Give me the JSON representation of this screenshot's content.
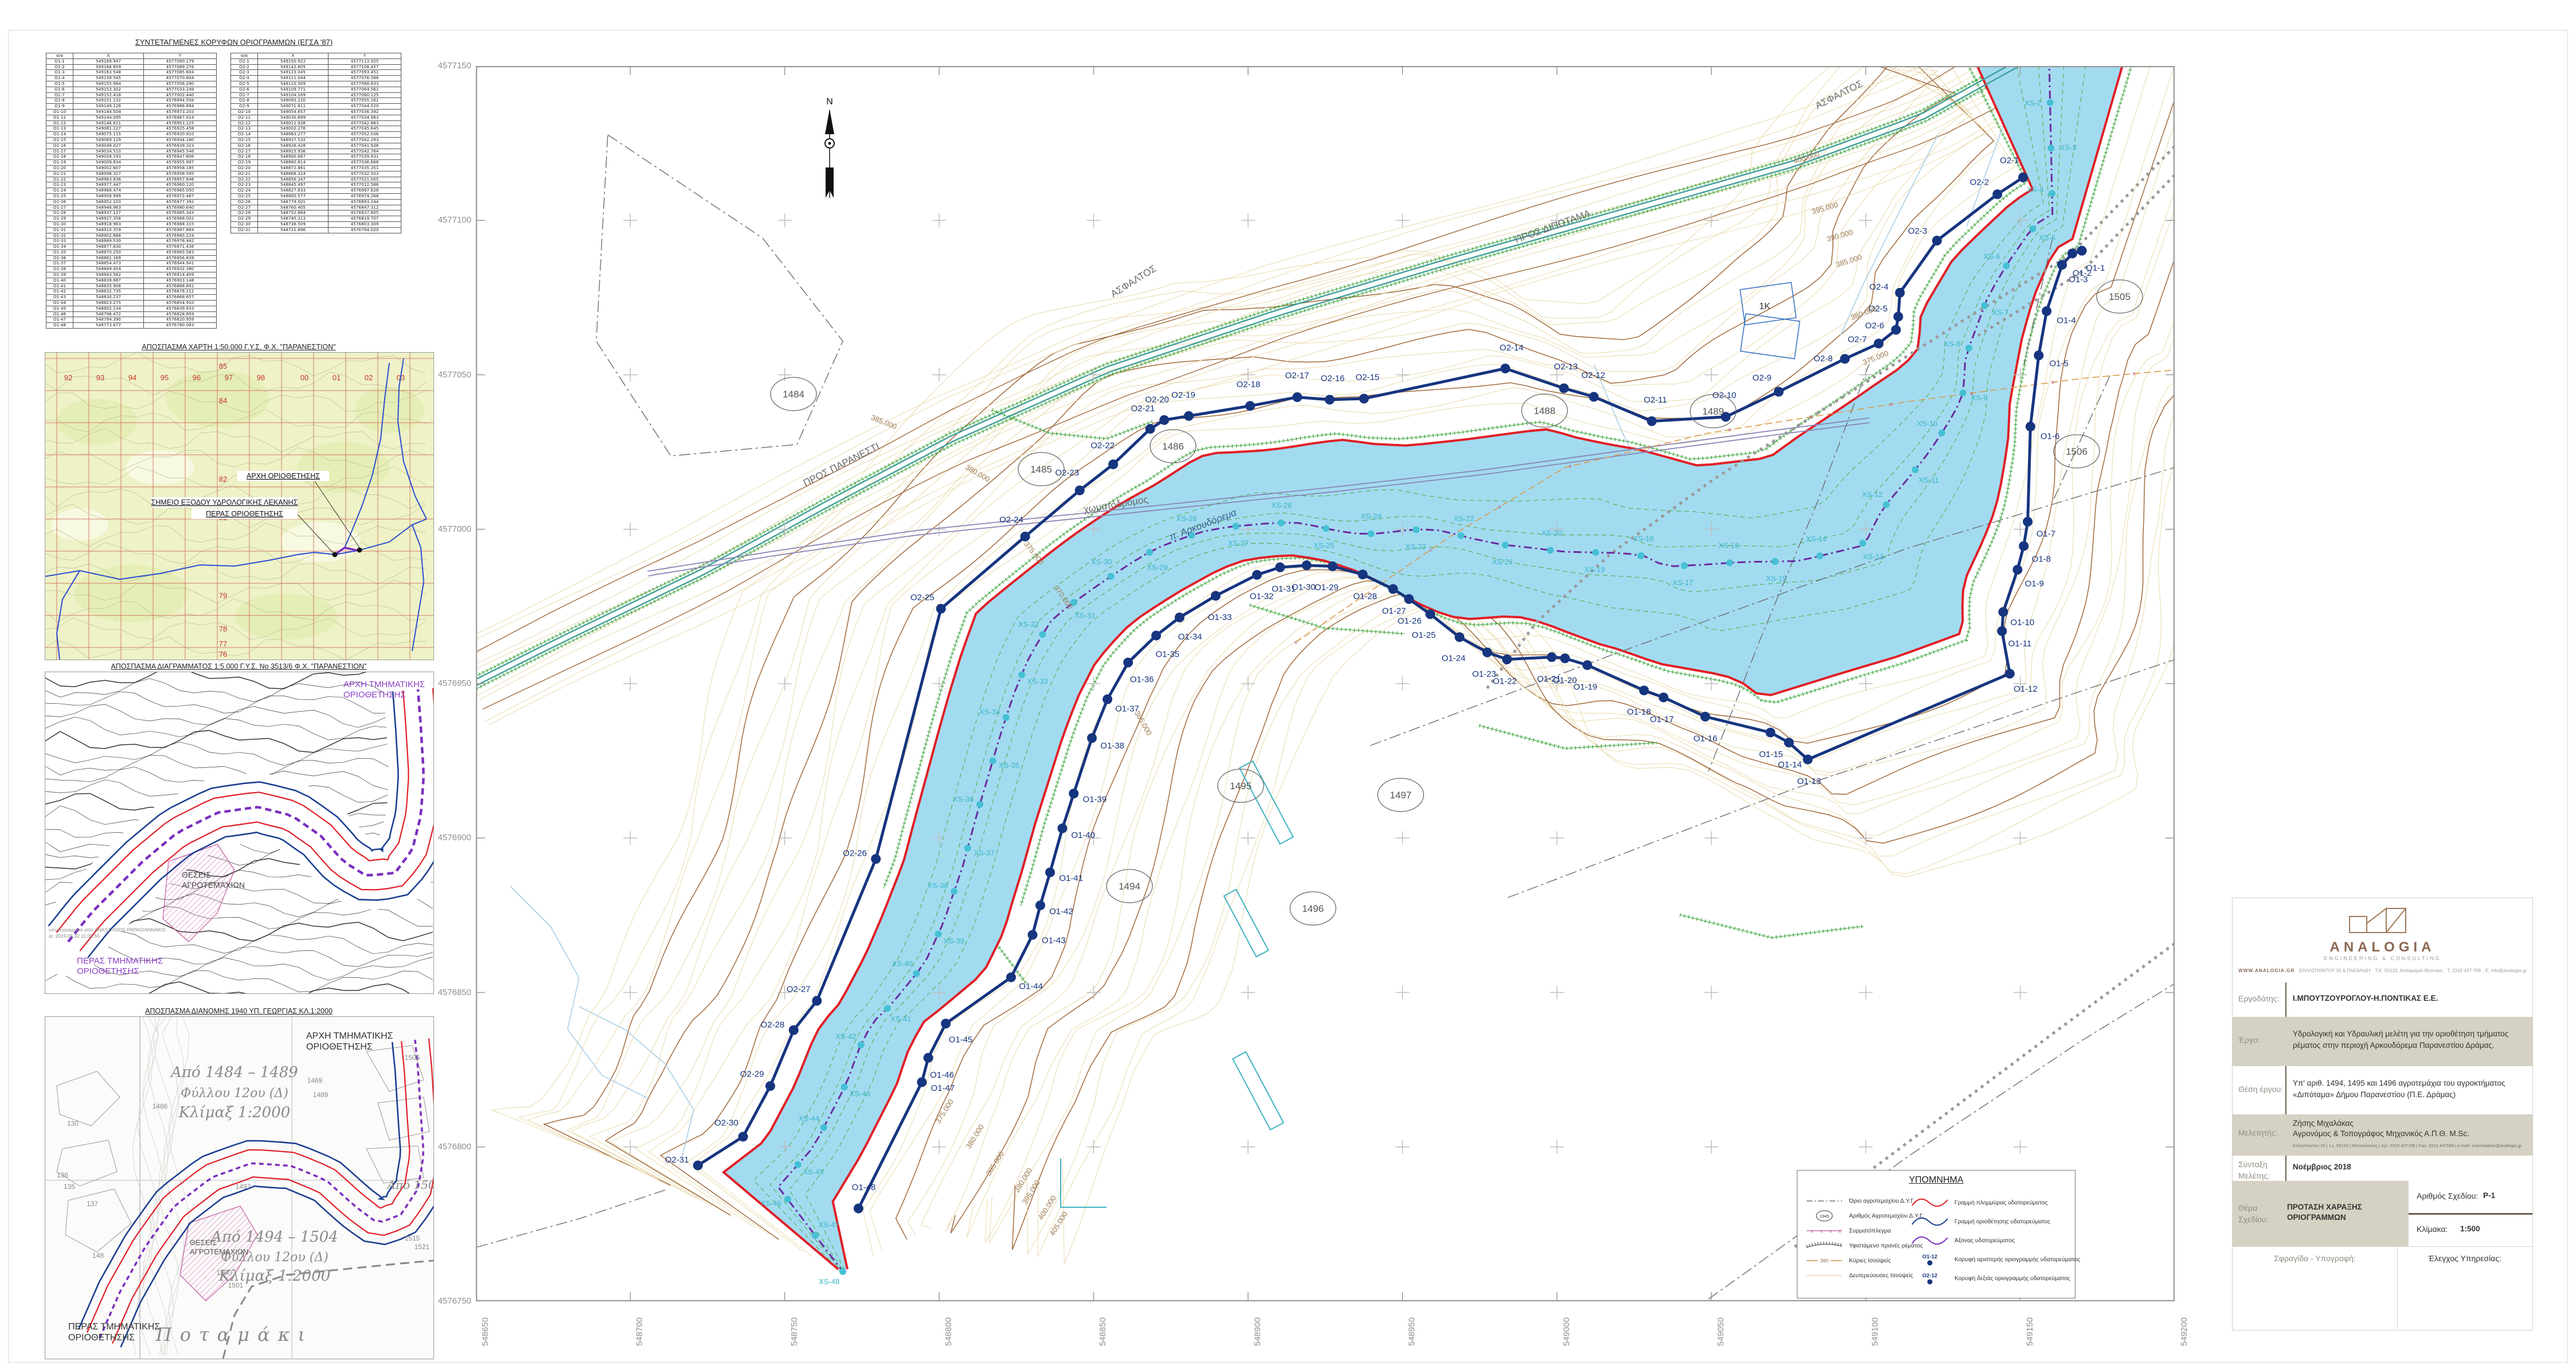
{
  "tables": {
    "title": "ΣΥΝΤΕΤΑΓΜΕΝΕΣ ΚΟΡΥΦΩΝ ΟΡΙΟΓΡΑΜΜΩΝ (ΕΓΣΑ '87)",
    "columns": [
      "α/α",
      "X",
      "Y"
    ],
    "o1": [
      [
        "O1-1",
        "549169.947",
        "4577090.179"
      ],
      [
        "O1-2",
        "549166.859",
        "4577089.276"
      ],
      [
        "O1-3",
        "549163.548",
        "4577085.604"
      ],
      [
        "O1-4",
        "549158.545",
        "4577070.604"
      ],
      [
        "O1-5",
        "549155.984",
        "4577056.290"
      ],
      [
        "O1-6",
        "549153.302",
        "4577033.249"
      ],
      [
        "O1-7",
        "549152.418",
        "4577002.440"
      ],
      [
        "O1-8",
        "549151.132",
        "4576994.556"
      ],
      [
        "O1-9",
        "549149.128",
        "4576986.894"
      ],
      [
        "O1-10",
        "549144.504",
        "4576973.203"
      ],
      [
        "O1-11",
        "549144.095",
        "4576967.014"
      ],
      [
        "O1-12",
        "549146.611",
        "4576953.225"
      ],
      [
        "O1-13",
        "549081.227",
        "4576925.458"
      ],
      [
        "O1-14",
        "549075.115",
        "4576930.910"
      ],
      [
        "O1-15",
        "549069.129",
        "4576934.180"
      ],
      [
        "O1-16",
        "549048.027",
        "4576939.323"
      ],
      [
        "O1-17",
        "549034.510",
        "4576945.546"
      ],
      [
        "O1-18",
        "549028.193",
        "4576947.806"
      ],
      [
        "O1-19",
        "549009.834",
        "4576955.997"
      ],
      [
        "O1-20",
        "549002.607",
        "4576958.185"
      ],
      [
        "O1-21",
        "548998.327",
        "4576958.595"
      ],
      [
        "O1-22",
        "548983.836",
        "4576957.846"
      ],
      [
        "O1-23",
        "548977.447",
        "4576960.120"
      ],
      [
        "O1-24",
        "548968.474",
        "4576965.050"
      ],
      [
        "O1-25",
        "548958.999",
        "4576972.487"
      ],
      [
        "O1-26",
        "548952.103",
        "4576977.392"
      ],
      [
        "O1-27",
        "548946.963",
        "4576980.640"
      ],
      [
        "O1-28",
        "548937.127",
        "4576985.343"
      ],
      [
        "O1-29",
        "548927.358",
        "4576988.002"
      ],
      [
        "O1-30",
        "548918.963",
        "4576988.315"
      ],
      [
        "O1-31",
        "548910.359",
        "4576987.664"
      ],
      [
        "O1-32",
        "548902.888",
        "4576985.224"
      ],
      [
        "O1-33",
        "548889.530",
        "4576978.442"
      ],
      [
        "O1-34",
        "548877.830",
        "4576971.436"
      ],
      [
        "O1-35",
        "548870.250",
        "4576965.583"
      ],
      [
        "O1-36",
        "548861.169",
        "4576956.839"
      ],
      [
        "O1-37",
        "548854.473",
        "4576944.941"
      ],
      [
        "O1-38",
        "548849.454",
        "4576932.380"
      ],
      [
        "O1-39",
        "548843.562",
        "4576914.409"
      ],
      [
        "O1-40",
        "548839.887",
        "4576903.148"
      ],
      [
        "O1-41",
        "548835.906",
        "4576888.891"
      ],
      [
        "O1-42",
        "548832.735",
        "4576878.212"
      ],
      [
        "O1-43",
        "548830.237",
        "4576868.657"
      ],
      [
        "O1-44",
        "548823.275",
        "4576854.910"
      ],
      [
        "O1-45",
        "548802.134",
        "4576839.933"
      ],
      [
        "O1-46",
        "548796.472",
        "4576828.859"
      ],
      [
        "O1-47",
        "548794.390",
        "4576820.959"
      ],
      [
        "O1-48",
        "548773.877",
        "4576780.083"
      ]
    ],
    "o2": [
      [
        "O2-1",
        "549150.922",
        "4577113.925"
      ],
      [
        "O2-2",
        "549142.605",
        "4577108.457"
      ],
      [
        "O2-3",
        "549123.045",
        "4577093.451"
      ],
      [
        "O2-4",
        "549111.044",
        "4577076.586"
      ],
      [
        "O2-5",
        "549110.509",
        "4577068.833"
      ],
      [
        "O2-6",
        "549109.771",
        "4577064.561"
      ],
      [
        "O2-7",
        "549104.169",
        "4577060.125"
      ],
      [
        "O2-8",
        "549093.220",
        "4577055.161"
      ],
      [
        "O2-9",
        "549071.811",
        "4577044.520"
      ],
      [
        "O2-10",
        "549054.657",
        "4577036.392"
      ],
      [
        "O2-11",
        "549030.699",
        "4577034.983"
      ],
      [
        "O2-12",
        "549011.938",
        "4577042.883"
      ],
      [
        "O2-13",
        "549002.276",
        "4577045.645"
      ],
      [
        "O2-14",
        "548983.277",
        "4577052.036"
      ],
      [
        "O2-15",
        "548937.532",
        "4577042.293"
      ],
      [
        "O2-16",
        "548926.428",
        "4577041.936"
      ],
      [
        "O2-17",
        "548915.936",
        "4577042.764"
      ],
      [
        "O2-18",
        "548900.667",
        "4577039.931"
      ],
      [
        "O2-19",
        "548880.814",
        "4577036.668"
      ],
      [
        "O2-20",
        "548872.861",
        "4577035.351"
      ],
      [
        "O2-21",
        "548868.324",
        "4577032.503"
      ],
      [
        "O2-22",
        "548856.347",
        "4577021.005"
      ],
      [
        "O2-23",
        "548845.497",
        "4577012.588"
      ],
      [
        "O2-24",
        "548827.833",
        "4576997.628"
      ],
      [
        "O2-25",
        "548800.577",
        "4576974.268"
      ],
      [
        "O2-26",
        "548779.501",
        "4576893.244"
      ],
      [
        "O2-27",
        "548760.405",
        "4576847.312"
      ],
      [
        "O2-28",
        "548752.884",
        "4576837.805"
      ],
      [
        "O2-29",
        "548745.313",
        "4576819.707"
      ],
      [
        "O2-30",
        "548736.509",
        "4576803.309"
      ],
      [
        "O2-31",
        "548721.896",
        "4576794.020"
      ]
    ]
  },
  "insets": {
    "map50k": {
      "title": "ΑΠΟΣΠΑΣΜΑ ΧΑΡΤΗ 1:50.000 Γ.Υ.Σ. Φ.Χ. \"ΠΑΡΑΝΕΣΤΙΟΝ\"",
      "labels": {
        "arxi": "ΑΡΧΗ ΟΡΙΟΘΕΤΗΣΗΣ",
        "shmeio": "ΣΗΜΕΙΟ ΕΞΟΔΟΥ ΥΔΡΟΛΟΓΙΚΗΣ ΛΕΚΑΝΗΣ",
        "peras": "ΠΕΡΑΣ ΟΡΙΟΘΕΤΗΣΗΣ"
      },
      "grid_top": [
        "92",
        "93",
        "94",
        "95",
        "96",
        "97",
        "98",
        "00",
        "01",
        "02",
        "03"
      ],
      "grid_side": [
        "85",
        "84",
        "82",
        "81",
        "79",
        "78",
        "77",
        "76"
      ]
    },
    "diagram5k": {
      "title": "ΑΠΟΣΠΑΣΜΑ ΔΙΑΓΡΑΜΜΑΤΟΣ 1:5.000 Γ.Υ.Σ. Νο 3513/6 Φ.Χ. \"ΠΑΡΑΝΕΣΤΙΟΝ\"",
      "labels": {
        "arxi1": "ΑΡΧΗ ΤΜΗΜΑΤΙΚΗΣ",
        "arxi2": "ΟΡΙΟΘΕΤΗΣΗΣ",
        "peras1": "ΠΕΡΑΣ ΤΜΗΜΑΤΙΚΗΣ",
        "peras2": "ΟΡΙΟΘΕΤΗΣΗΣ",
        "theseis1": "ΘΕΣΕΙΣ",
        "theseis2": "ΑΓΡΟΤΕΜΑΧΙΩΝ",
        "sig1": "υπογεγραμμένο από ANASTASIOS PAPAGIANNAKIS",
        "sig2": "ία: 2019.05.02 11:09:55"
      }
    },
    "dianomi1940": {
      "title": "ΑΠΟΣΠΑΣΜΑ ΔΙΑΝΟΜΗΣ 1940 ΥΠ. ΓΕΩΡΓΙΑΣ ΚΛ.1:2000",
      "labels": {
        "arxi1": "ΑΡΧΗ ΤΜΗΜΑΤΙΚΗΣ",
        "arxi2": "ΟΡΙΟΘΕΤΗΣΗΣ",
        "peras1": "ΠΕΡΑΣ ΤΜΗΜΑΤΙΚΗΣ",
        "peras2": "ΟΡΙΟΘΕΤΗΣΗΣ",
        "theseis1": "ΘΕΣΕΙΣ",
        "theseis2": "ΑΓΡΟΤΕΜΑΧΙΩΝ",
        "hand1a": "Από 1484 – 1489",
        "hand1b": "Φύλλου 12ου (Δ)",
        "hand1c": "Κλίμαξ 1:2000",
        "hand2a": "Από 1494 – 1504",
        "hand2b": "Φύλλου 12ου (Δ)",
        "hand2c": "Κλίμαξ 1:2000",
        "hand3a": "Από 1505",
        "potamaki": "Ποταμάκι"
      },
      "numbers": [
        "130",
        "136",
        "135",
        "137",
        "148",
        "1497",
        "1500",
        "1501",
        "1505",
        "1515",
        "1521",
        "1489",
        "1469",
        "1486"
      ]
    }
  },
  "main_map": {
    "x_ticks": [
      "548650",
      "548700",
      "548750",
      "548800",
      "548850",
      "548900",
      "548950",
      "549000",
      "549050",
      "549100",
      "549150",
      "549200"
    ],
    "y_ticks": [
      "4577150",
      "4577100",
      "4577050",
      "4577000",
      "4576950",
      "4576900",
      "4576850",
      "4576800",
      "4576750"
    ],
    "north_label": "N",
    "river_label": "π. Αρκουδόρεμα",
    "road_labels": [
      {
        "t": "ΠΡΟΣ ΠΑΡΑΝΕΣΤΙ",
        "x": 640,
        "y": 700,
        "r": -27
      },
      {
        "t": "ΑΣΦΑΛΤΟΣ",
        "x": 1150,
        "y": 380,
        "r": -32
      },
      {
        "t": "ΑΣΦΑΛΤΟΣ",
        "x": 2380,
        "y": 55,
        "r": -27
      },
      {
        "t": "χωματόδρομος",
        "x": 1117,
        "y": 770,
        "r": -9
      },
      {
        "t": "ΠΡΟΣ ΔΙΠΟΤΑΜΑ",
        "x": 1880,
        "y": 285,
        "r": -20
      }
    ],
    "contour_labels": [
      {
        "t": "400.000",
        "x": 2322,
        "y": 164,
        "r": -16
      },
      {
        "t": "395.000",
        "x": 2354,
        "y": 252,
        "r": -16
      },
      {
        "t": "390.000",
        "x": 2380,
        "y": 300,
        "r": -16
      },
      {
        "t": "385.000",
        "x": 2396,
        "y": 344,
        "r": -18
      },
      {
        "t": "380.000",
        "x": 2422,
        "y": 435,
        "r": -20
      },
      {
        "t": "375.000",
        "x": 2443,
        "y": 513,
        "r": -22
      },
      {
        "t": "385.000",
        "x": 710,
        "y": 625,
        "r": 22
      },
      {
        "t": "380.000",
        "x": 873,
        "y": 714,
        "r": 30
      },
      {
        "t": "375.000",
        "x": 970,
        "y": 852,
        "r": 52
      },
      {
        "t": "370.000",
        "x": 1021,
        "y": 929,
        "r": 55
      },
      {
        "t": "365.000",
        "x": 1160,
        "y": 1148,
        "r": 60
      },
      {
        "t": "375.000",
        "x": 821,
        "y": 1825,
        "r": -58
      },
      {
        "t": "380.000",
        "x": 874,
        "y": 1869,
        "r": -58
      },
      {
        "t": "385.000",
        "x": 909,
        "y": 1916,
        "r": -58
      },
      {
        "t": "390.000",
        "x": 958,
        "y": 1945,
        "r": -58
      },
      {
        "t": "395.000",
        "x": 972,
        "y": 1966,
        "r": -58
      },
      {
        "t": "400.000",
        "x": 1000,
        "y": 1993,
        "r": -58
      },
      {
        "t": "405.000",
        "x": 1020,
        "y": 2021,
        "r": -58
      }
    ],
    "parcels": [
      {
        "id": "1484",
        "x": 554,
        "y": 572
      },
      {
        "id": "1485",
        "x": 986,
        "y": 703
      },
      {
        "id": "1486",
        "x": 1216,
        "y": 663
      },
      {
        "id": "1488",
        "x": 1864,
        "y": 601
      },
      {
        "id": "1489",
        "x": 2158,
        "y": 602
      },
      {
        "id": "1494",
        "x": 1140,
        "y": 1430
      },
      {
        "id": "1495",
        "x": 1334,
        "y": 1255
      },
      {
        "id": "1496",
        "x": 1460,
        "y": 1469
      },
      {
        "id": "1497",
        "x": 1613,
        "y": 1271
      },
      {
        "id": "1505",
        "x": 2867,
        "y": 402
      },
      {
        "id": "1506",
        "x": 2792,
        "y": 672
      }
    ],
    "building_label": "1K",
    "xs_labels": [
      "XS-1",
      "XS-2",
      "XS-3",
      "XS-4",
      "XS-5",
      "XS-6",
      "XS-7",
      "XS-8",
      "XS-9",
      "XS-10",
      "XS-11",
      "XS-12",
      "XS-13",
      "XS-14",
      "XS-15",
      "XS-16",
      "XS-17",
      "XS-18",
      "XS-19",
      "XS-20",
      "XS-21",
      "XS-22",
      "XS-23",
      "XS-24",
      "XS-25",
      "XS-26",
      "XS-27",
      "XS-28",
      "XS-29",
      "XS-30",
      "XS-31",
      "XS-32",
      "XS-33",
      "XS-34",
      "XS-35",
      "XS-36",
      "XS-37",
      "XS-38",
      "XS-39",
      "XS-40",
      "XS-41",
      "XS-42",
      "XS-43",
      "XS-44",
      "XS-45",
      "XS-46",
      "XS-47",
      "XS-48"
    ]
  },
  "legend": {
    "title": "ΥΠΟΜΝΗΜΑ",
    "items_left": [
      {
        "sym": "dashdot",
        "label": "Όριο αγροτεμαχίου Δ.Υ.Γ."
      },
      {
        "sym": "circle1945",
        "tag": "1945",
        "label": "Αριθμός Αγροτεμαχίου Δ.Υ.Γ."
      },
      {
        "sym": "fence",
        "label": "Συρματόπλεγμα"
      },
      {
        "sym": "slope",
        "label": "Υφιστάμενο πρανές ρέματος"
      },
      {
        "sym": "contour-major",
        "tag": "380",
        "label": "Κύριες Ισοϋψείς"
      },
      {
        "sym": "contour-minor",
        "label": "Δευτερεύουσες Ισοϋψείς"
      }
    ],
    "items_right": [
      {
        "sym": "wave-red",
        "label": "Γραμμή πλημμύρας υδατορεύματος"
      },
      {
        "sym": "wave-blue",
        "label": "Γραμμή οριοθέτησης υδατορεύματος"
      },
      {
        "sym": "wave-purple",
        "label": "Άξονας υδατορεύματος"
      },
      {
        "sym": "point-o",
        "tag": "O1-12",
        "label": "Κορυφή αριστερής οριογραμμής υδατορεύματος"
      },
      {
        "sym": "point-o",
        "tag": "O2-12",
        "label": "Κορυφή δεξιάς οριογραμμής υδατορεύματος"
      }
    ]
  },
  "titleblock": {
    "logo_name": "ANALOGIA",
    "logo_sub": "ENGINEERING & CONSULTING",
    "contact": [
      "WWW.ANALOGIA.GR",
      "ΕΛΛΗΣΠΟΝΤΟΥ 26 & ΠΑΣΑΛΙΔΗ",
      "Τ.Κ. 55132, Καλαμαριά-Θεσ/νίκη",
      "T. 2310 437 799",
      "E. info@analogia.gr"
    ],
    "rows": {
      "ergodotis_label": "Εργοδότης:",
      "ergodotis": "Ι.ΜΠΟΥΤΖΟΥΡΟΓΛΟΥ-Η.ΠΟΝΤΙΚΑΣ Ε.Ε.",
      "ergo_label": "Έργο:",
      "ergo": "Υδρολογική και Υδραυλική μελέτη για την οριοθέτηση τμήματος ρέματος στην περιοχή Αρκουδόρεμα Παρανεστίου Δράμας.",
      "thesi_label": "Θέση έργου:",
      "thesi": "Υπ' αριθ. 1494, 1495 και 1496 αγροτεμάχια του αγροκτήματος «Διπόταμα» Δήμου Παρανεστίου (Π.Ε. Δράμας)",
      "meletitis_label": "Μελετητής:",
      "meletitis1": "Ζήσης Μιχαλάκας",
      "meletitis2": "Αγρονόμος & Τοπογράφος Μηχανικός Α.Π.Θ. M.Sc.",
      "meletitis3": "Ελλησπόντου 26 | τ.κ. 55132 | Θεσσαλονίκη | τηλ: 2310 437799 | Fax: 2310 447599 | e-mail: zmichalakas@analogia.gr",
      "syntaxi_label": "Σύνταξη Μελέτης:",
      "syntaxi": "Νοέμβριος 2018",
      "thema_label": "Θέμα Σχεδίου:",
      "thema1": "ΠΡΟΤΑΣΗ ΧΑΡΑΞΗΣ",
      "thema2": "ΟΡΙΟΓΡΑΜΜΩΝ",
      "arithmos_label": "Αριθμός Σχεδίου:",
      "arithmos": "P-1",
      "klimaka_label": "Κλίμακα:",
      "klimaka": "1:500",
      "sfragida_label": "Σφραγίδα - Υπογραφή:",
      "elegxos_label": "Έλεγχος Υπηρεσίας:"
    }
  }
}
